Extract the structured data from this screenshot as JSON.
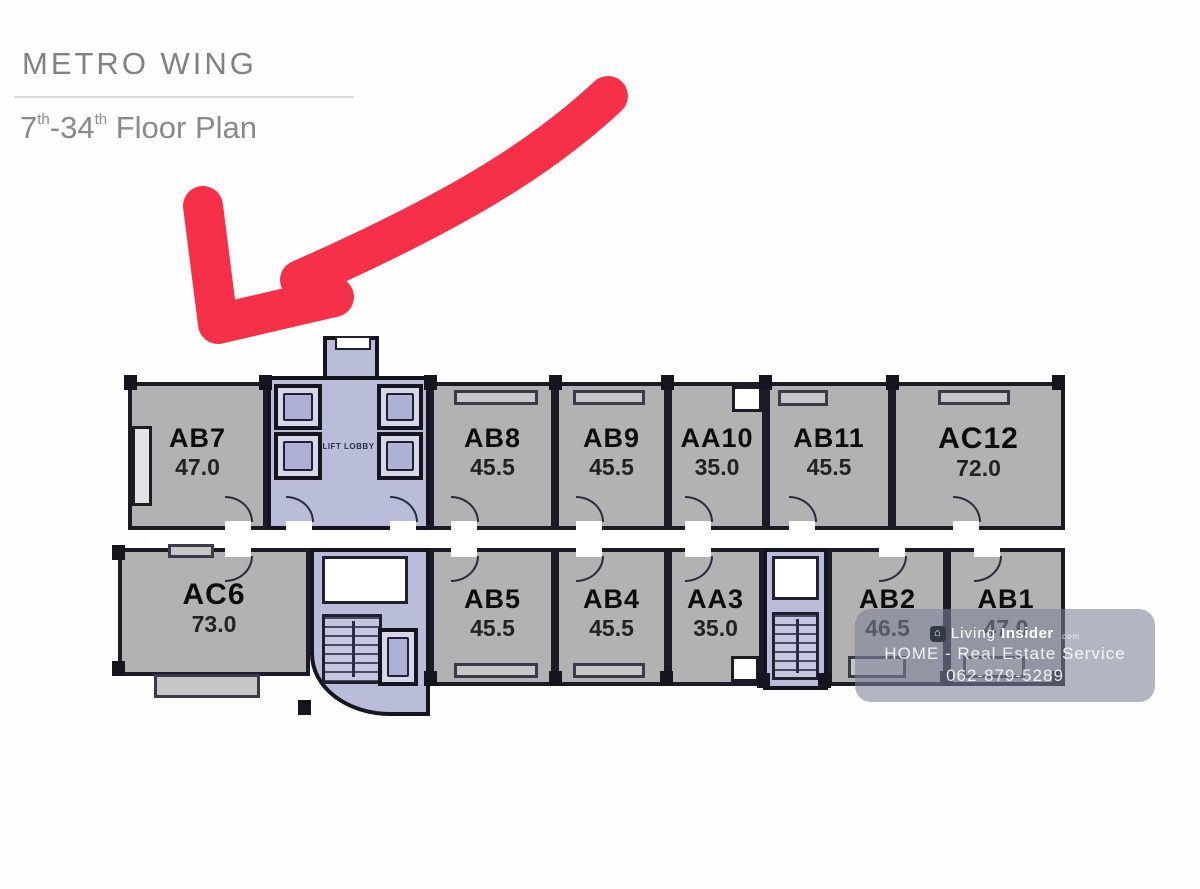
{
  "header": {
    "title": "METRO WING",
    "subtitle": {
      "from": "7",
      "from_sup": "th",
      "sep": "-",
      "to": "34",
      "to_sup": "th",
      "rest": " Floor Plan"
    }
  },
  "annotation": {
    "arrow_color": "#f63048",
    "points_to": "AB7"
  },
  "floor_plan": {
    "labels": {
      "lift_lobby": "LIFT LOBBY"
    },
    "colors": {
      "wall": "#1c1c28",
      "unit_fill": "#b2b2b2",
      "core_fill": "#b9bdda",
      "corridor_fill": "#ffffff",
      "title_text": "#8a8a8a"
    },
    "top_row": [
      {
        "id": "AB7",
        "area": "47.0"
      },
      {
        "id": "AB8",
        "area": "45.5"
      },
      {
        "id": "AB9",
        "area": "45.5"
      },
      {
        "id": "AA10",
        "area": "35.0"
      },
      {
        "id": "AB11",
        "area": "45.5"
      },
      {
        "id": "AC12",
        "area": "72.0"
      }
    ],
    "bottom_row": [
      {
        "id": "AC6",
        "area": "73.0"
      },
      {
        "id": "AB5",
        "area": "45.5"
      },
      {
        "id": "AB4",
        "area": "45.5"
      },
      {
        "id": "AA3",
        "area": "35.0"
      },
      {
        "id": "AB2",
        "area": "46.5"
      },
      {
        "id": "AB1",
        "area": "47.0"
      }
    ]
  },
  "watermark": {
    "brand_prefix": "Living",
    "brand_bold": "Insider",
    "brand_tld": ".com",
    "service_line": "HOME - Real Estate Service",
    "phone": "062-879-5289"
  }
}
